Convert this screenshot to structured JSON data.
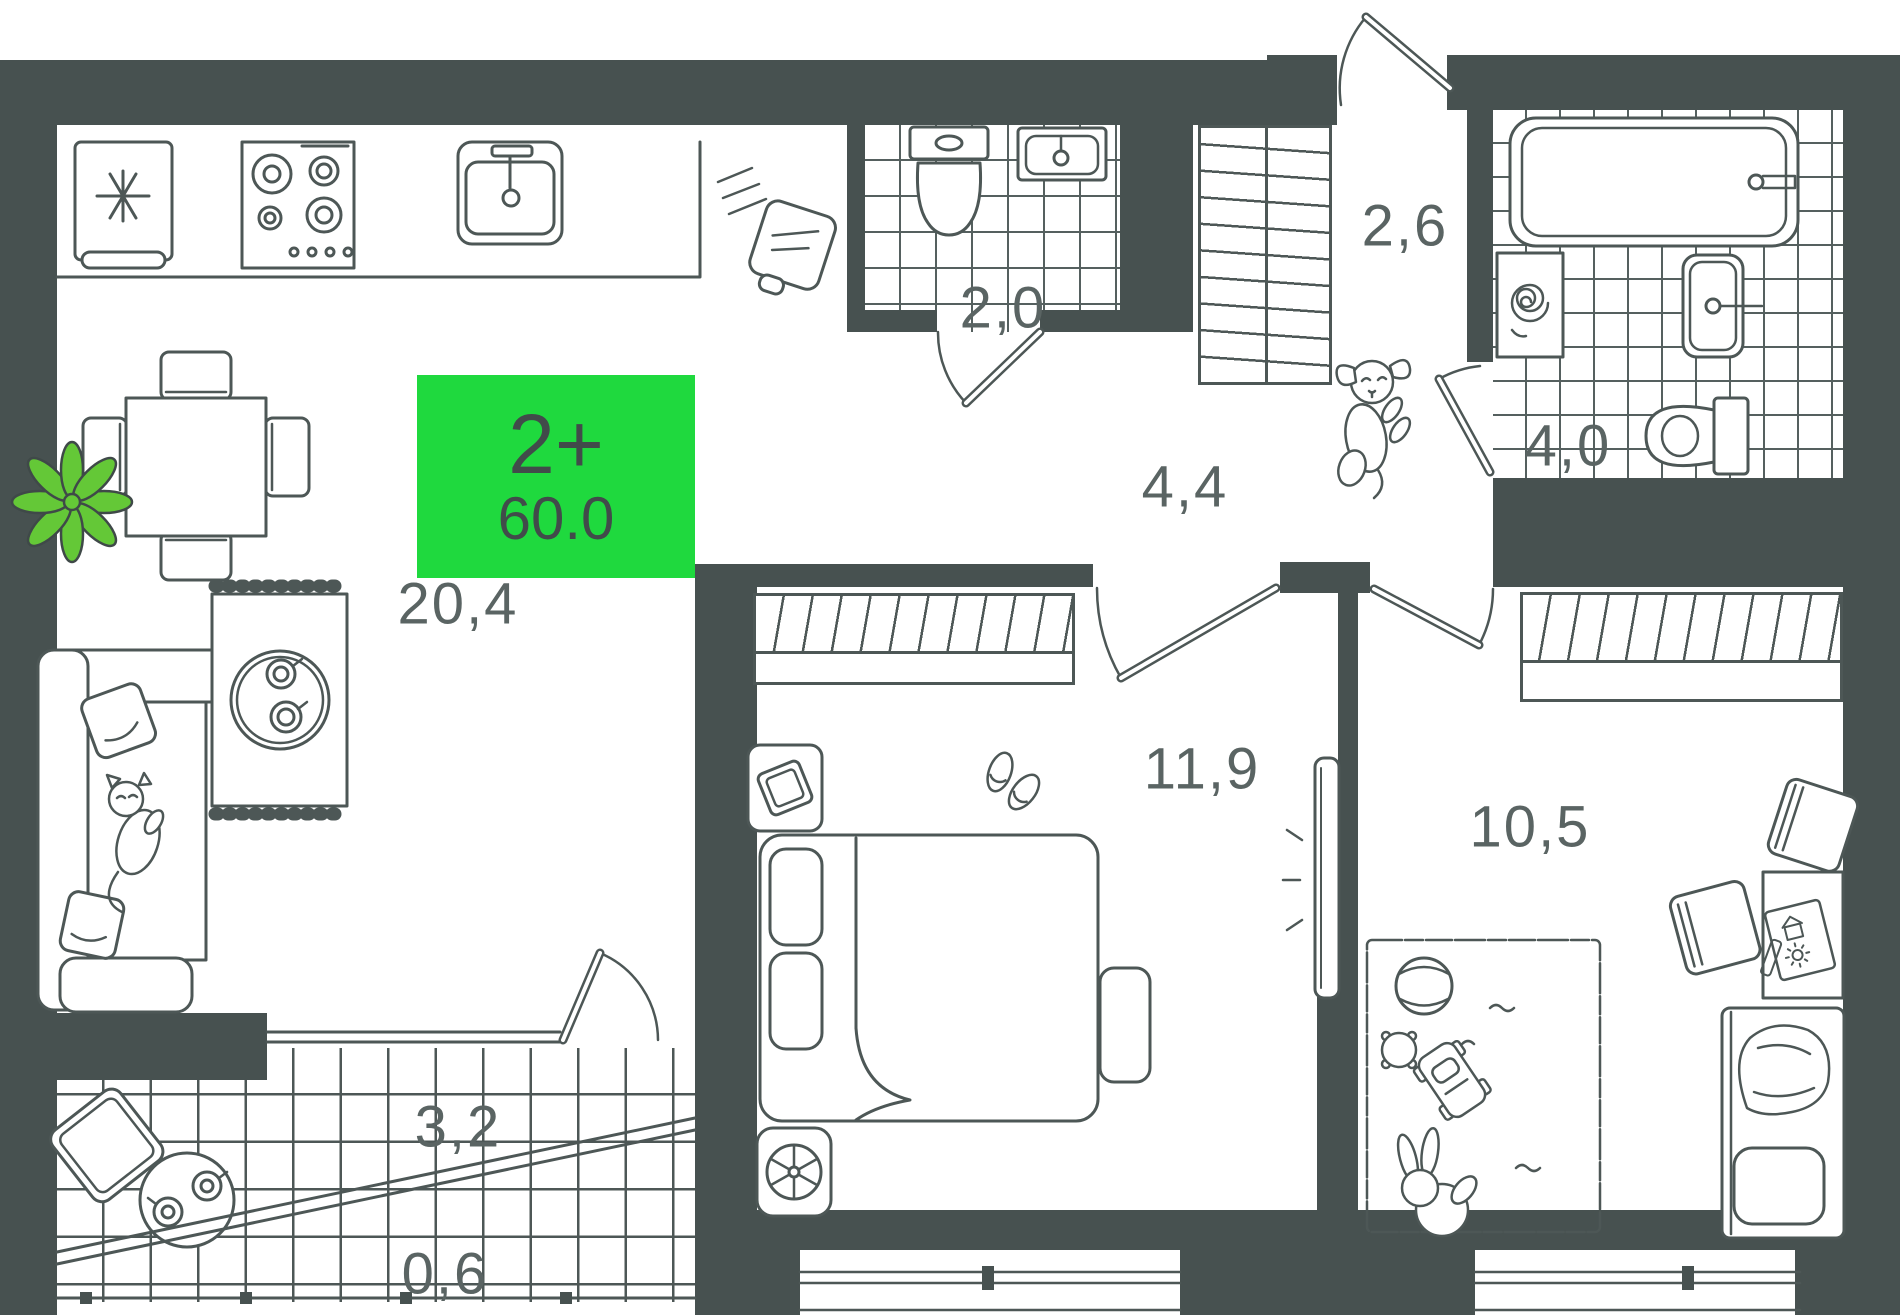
{
  "plan": {
    "badge": {
      "rooms_label": "2+",
      "area_label": "60.0"
    },
    "rooms": {
      "living": {
        "name": "living-kitchen",
        "area": "20,4"
      },
      "bath_small": {
        "name": "wc",
        "area": "2,0"
      },
      "entry": {
        "name": "entry-hall",
        "area": "2,6"
      },
      "hall": {
        "name": "hallway",
        "area": "4,4"
      },
      "bath_big": {
        "name": "bathroom",
        "area": "4,0"
      },
      "bedroom": {
        "name": "bedroom",
        "area": "11,9"
      },
      "kids": {
        "name": "kids-room",
        "area": "10,5"
      },
      "balcony": {
        "name": "balcony",
        "area": "3,2"
      },
      "balcony_edge": {
        "name": "balcony-ledge",
        "area": "0,6"
      }
    },
    "colors": {
      "wall": "#475150",
      "line": "#4d5756",
      "badge_green": "#1fd93e",
      "badge_text": "#414b4a",
      "label_text": "#5a6463",
      "plant_green": "#64c837"
    }
  }
}
